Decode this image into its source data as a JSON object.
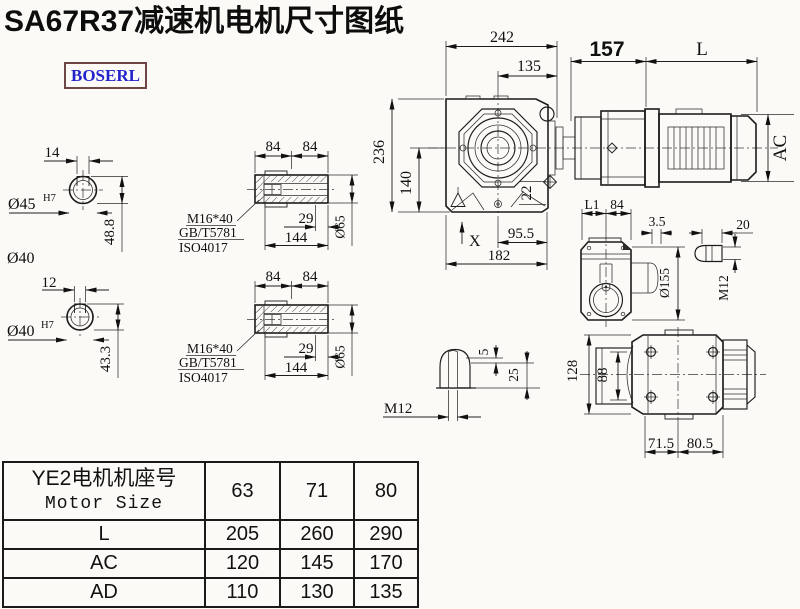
{
  "title": "SA67R37减速机电机尺寸图纸",
  "brand": {
    "logo_text": "BOSERL"
  },
  "colors": {
    "background": "#fbfaf7",
    "line": "#1b1b1b",
    "logo_text": "#2323cc",
    "logo_border": "#6d4646"
  },
  "drawing": {
    "shaft_top": {
      "key_width": "14",
      "bore_dia": "Ø45",
      "bore_tol": "H7",
      "depth": "48.8",
      "note": "Ø40"
    },
    "shaft_bottom": {
      "key_width": "12",
      "bore_dia": "Ø40",
      "bore_tol": "H7",
      "depth": "43.3"
    },
    "sleeve": {
      "seg1": "84",
      "seg2": "84",
      "thread": "M16*40",
      "std1": "GB/T5781",
      "std2": "ISO4017",
      "engage": "29",
      "length": "144",
      "dia": "Ø65"
    },
    "main": {
      "total_width": "242",
      "center_width": "135",
      "adapter_len": "157",
      "motor_len": "L",
      "total_height": "236",
      "center_height": "140",
      "foot": "22",
      "motor_dia": "AC",
      "x_mark": "X",
      "foot_right": "95.5",
      "foot_total": "182"
    },
    "side": {
      "l1": "L1",
      "w84": "84",
      "plate": "3.5",
      "dia": "Ø155",
      "tab_len": "20",
      "tab_thread": "M12"
    },
    "key_detail": {
      "d5": "5",
      "d25": "25",
      "thread": "M12"
    },
    "bottom": {
      "h128": "128",
      "h88": "88",
      "w715": "71.5",
      "w805": "80.5"
    }
  },
  "table": {
    "header_cn": "YE2电机机座号",
    "header_en": "Motor Size",
    "sizes": [
      "63",
      "71",
      "80"
    ],
    "rows": [
      {
        "label": "L",
        "values": [
          "205",
          "260",
          "290"
        ]
      },
      {
        "label": "AC",
        "values": [
          "120",
          "145",
          "170"
        ]
      },
      {
        "label": "AD",
        "values": [
          "110",
          "130",
          "135"
        ]
      }
    ]
  }
}
